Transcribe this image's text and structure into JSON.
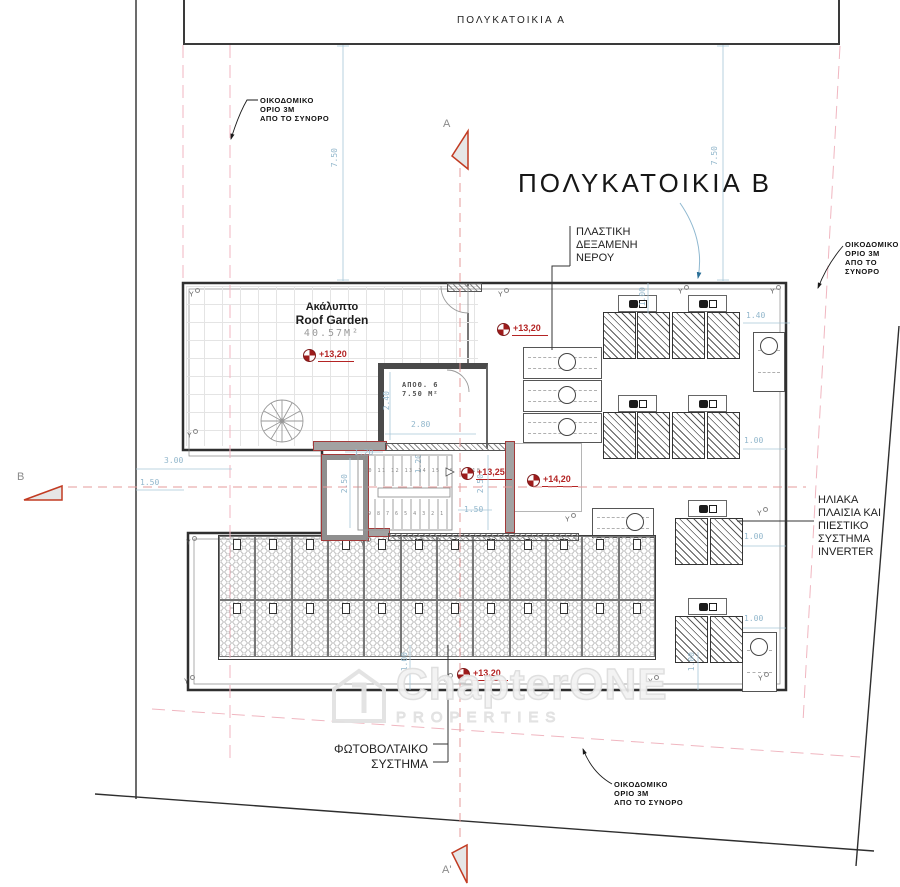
{
  "plan": {
    "building_a_label": "ΠΟΛΥΚΑΤΟΙΚΙΑ  Α",
    "building_b_title": "ΠΟΛΥΚΑΤΟΙΚΙΑ  Β",
    "roof_garden": {
      "name_gr": "Ακάλυπτο",
      "name_en": "Roof Garden",
      "area": "40.57M²"
    },
    "storage": {
      "name": "ΑΠΟΘ. 6",
      "area": "7.50 Μ²"
    },
    "notes": {
      "boundary": [
        "ΟΙΚΟΔΟΜΙΚΟ",
        "ΟΡΙΟ 3Μ",
        "ΑΠΟ ΤΟ ΣΥΝΟΡΟ"
      ],
      "water_tank": [
        "ΠΛΑΣΤΙΚΗ",
        "ΔΕΞΑΜΕΝΗ",
        "ΝΕΡΟΥ"
      ],
      "solar": [
        "ΗΛΙΑΚΑ",
        "ΠΛΑΙΣΙΑ ΚΑΙ",
        "ΠΙΕΣΤΙΚΟ",
        "ΣΥΣΤΗΜΑ",
        "INVERTER"
      ],
      "pv": [
        "ΦΩΤΟΒΟΛΤΑΙΚΟ",
        "ΣΥΣΤΗΜΑ"
      ]
    },
    "sections": {
      "a": "A",
      "a_prime": "A'",
      "b": "B"
    },
    "column_marker": "Y",
    "elevations": {
      "roof_garden": "+13,20",
      "tanks": "+13,20",
      "stair": "+13,25",
      "platform": "+14,20",
      "pv": "+13,20"
    },
    "dims": {
      "d750": "7.50",
      "d300": "3.00",
      "d150": "1.50",
      "d120": "1.20",
      "d250": "2.50",
      "d240": "2.40",
      "d280": "2.80",
      "d100": "1.00",
      "d140": "1.40"
    },
    "stair_numbers": {
      "upper": "10 11 12 13 14 15 16 17 18",
      "lower": "9 8 7 6 5 4 3 2 1"
    },
    "watermark": {
      "brand": "ChapterONE",
      "sub": "PROPERTIES"
    }
  }
}
